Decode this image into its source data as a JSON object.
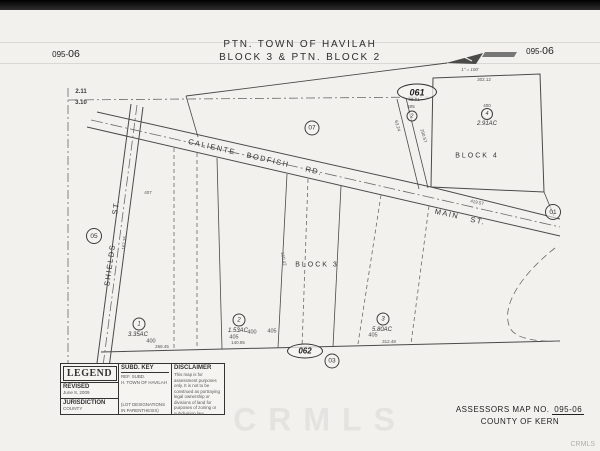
{
  "header": {
    "sheet_left_prefix": "095-",
    "sheet_left_suffix": "06",
    "sheet_right_prefix": "095-",
    "sheet_right_suffix": "06",
    "title1": "PTN. TOWN OF HAVILAH",
    "title2": "BLOCK 3 & PTN. BLOCK 2",
    "scale": "1\" = 100'"
  },
  "map": {
    "section": {
      "top": "2.11",
      "bottom": "3.10"
    },
    "streets": {
      "caliente": [
        "CALIENTE",
        "BODFISH",
        "RD."
      ],
      "main": [
        "MAIN",
        "ST."
      ],
      "shields": [
        "SHIELDS",
        "ST."
      ]
    },
    "blocks": {
      "b3": "BLOCK 3",
      "b4": "BLOCK 4"
    },
    "refs": {
      "c05": "05",
      "c07": "07",
      "c01": "01",
      "c03": "03",
      "e061": "061",
      "e062": "062"
    },
    "parcels": {
      "p1": {
        "no": "1",
        "ac": "3.35AC"
      },
      "p2": {
        "no": "2",
        "ac": "1.53AC"
      },
      "p3": {
        "no": "3",
        "ac": "5.80AC"
      },
      "p4": {
        "no": "4",
        "ac": "2.91AC"
      },
      "p2b": {
        "no": "2"
      }
    },
    "lots": [
      "400",
      "405",
      "400",
      "405",
      "405",
      "405",
      "400"
    ],
    "dims": {
      "d302": "302.12",
      "d268": "268.45",
      "d140": "140.85",
      "d312": "312.48",
      "d419": "419.57",
      "d167": "167.35",
      "d160": "160.42",
      "d290": "290.57",
      "d63": "63.24",
      "d62": "62.01",
      "d407": "407"
    }
  },
  "legend": {
    "title": "LEGEND",
    "revised_label": "REVISED",
    "revised_date": "June 8, 2009",
    "jurisdiction_label": "JURISDICTION",
    "jurisdiction_value": "COUNTY",
    "subd_key_title": "SUBD. KEY",
    "subd_ref": "REF.  SUBD.",
    "subd_row": "H.  TOWN OF HAVILAH",
    "subd_note": "(LOT DESIGNATIONS IN PARENTHESIS)",
    "disclaimer_title": "DISCLAIMER",
    "disclaimer_text": "This map is for assessment purposes only. It is not to be construed as portraying legal ownership or divisions of land for purposes of zoning or subdivision law."
  },
  "footer": {
    "assessors_label": "ASSESSORS MAP NO.",
    "map_no": "095-06",
    "county": "COUNTY OF KERN",
    "watermark": "CRMLS",
    "watermark_small": "CRMLS"
  }
}
